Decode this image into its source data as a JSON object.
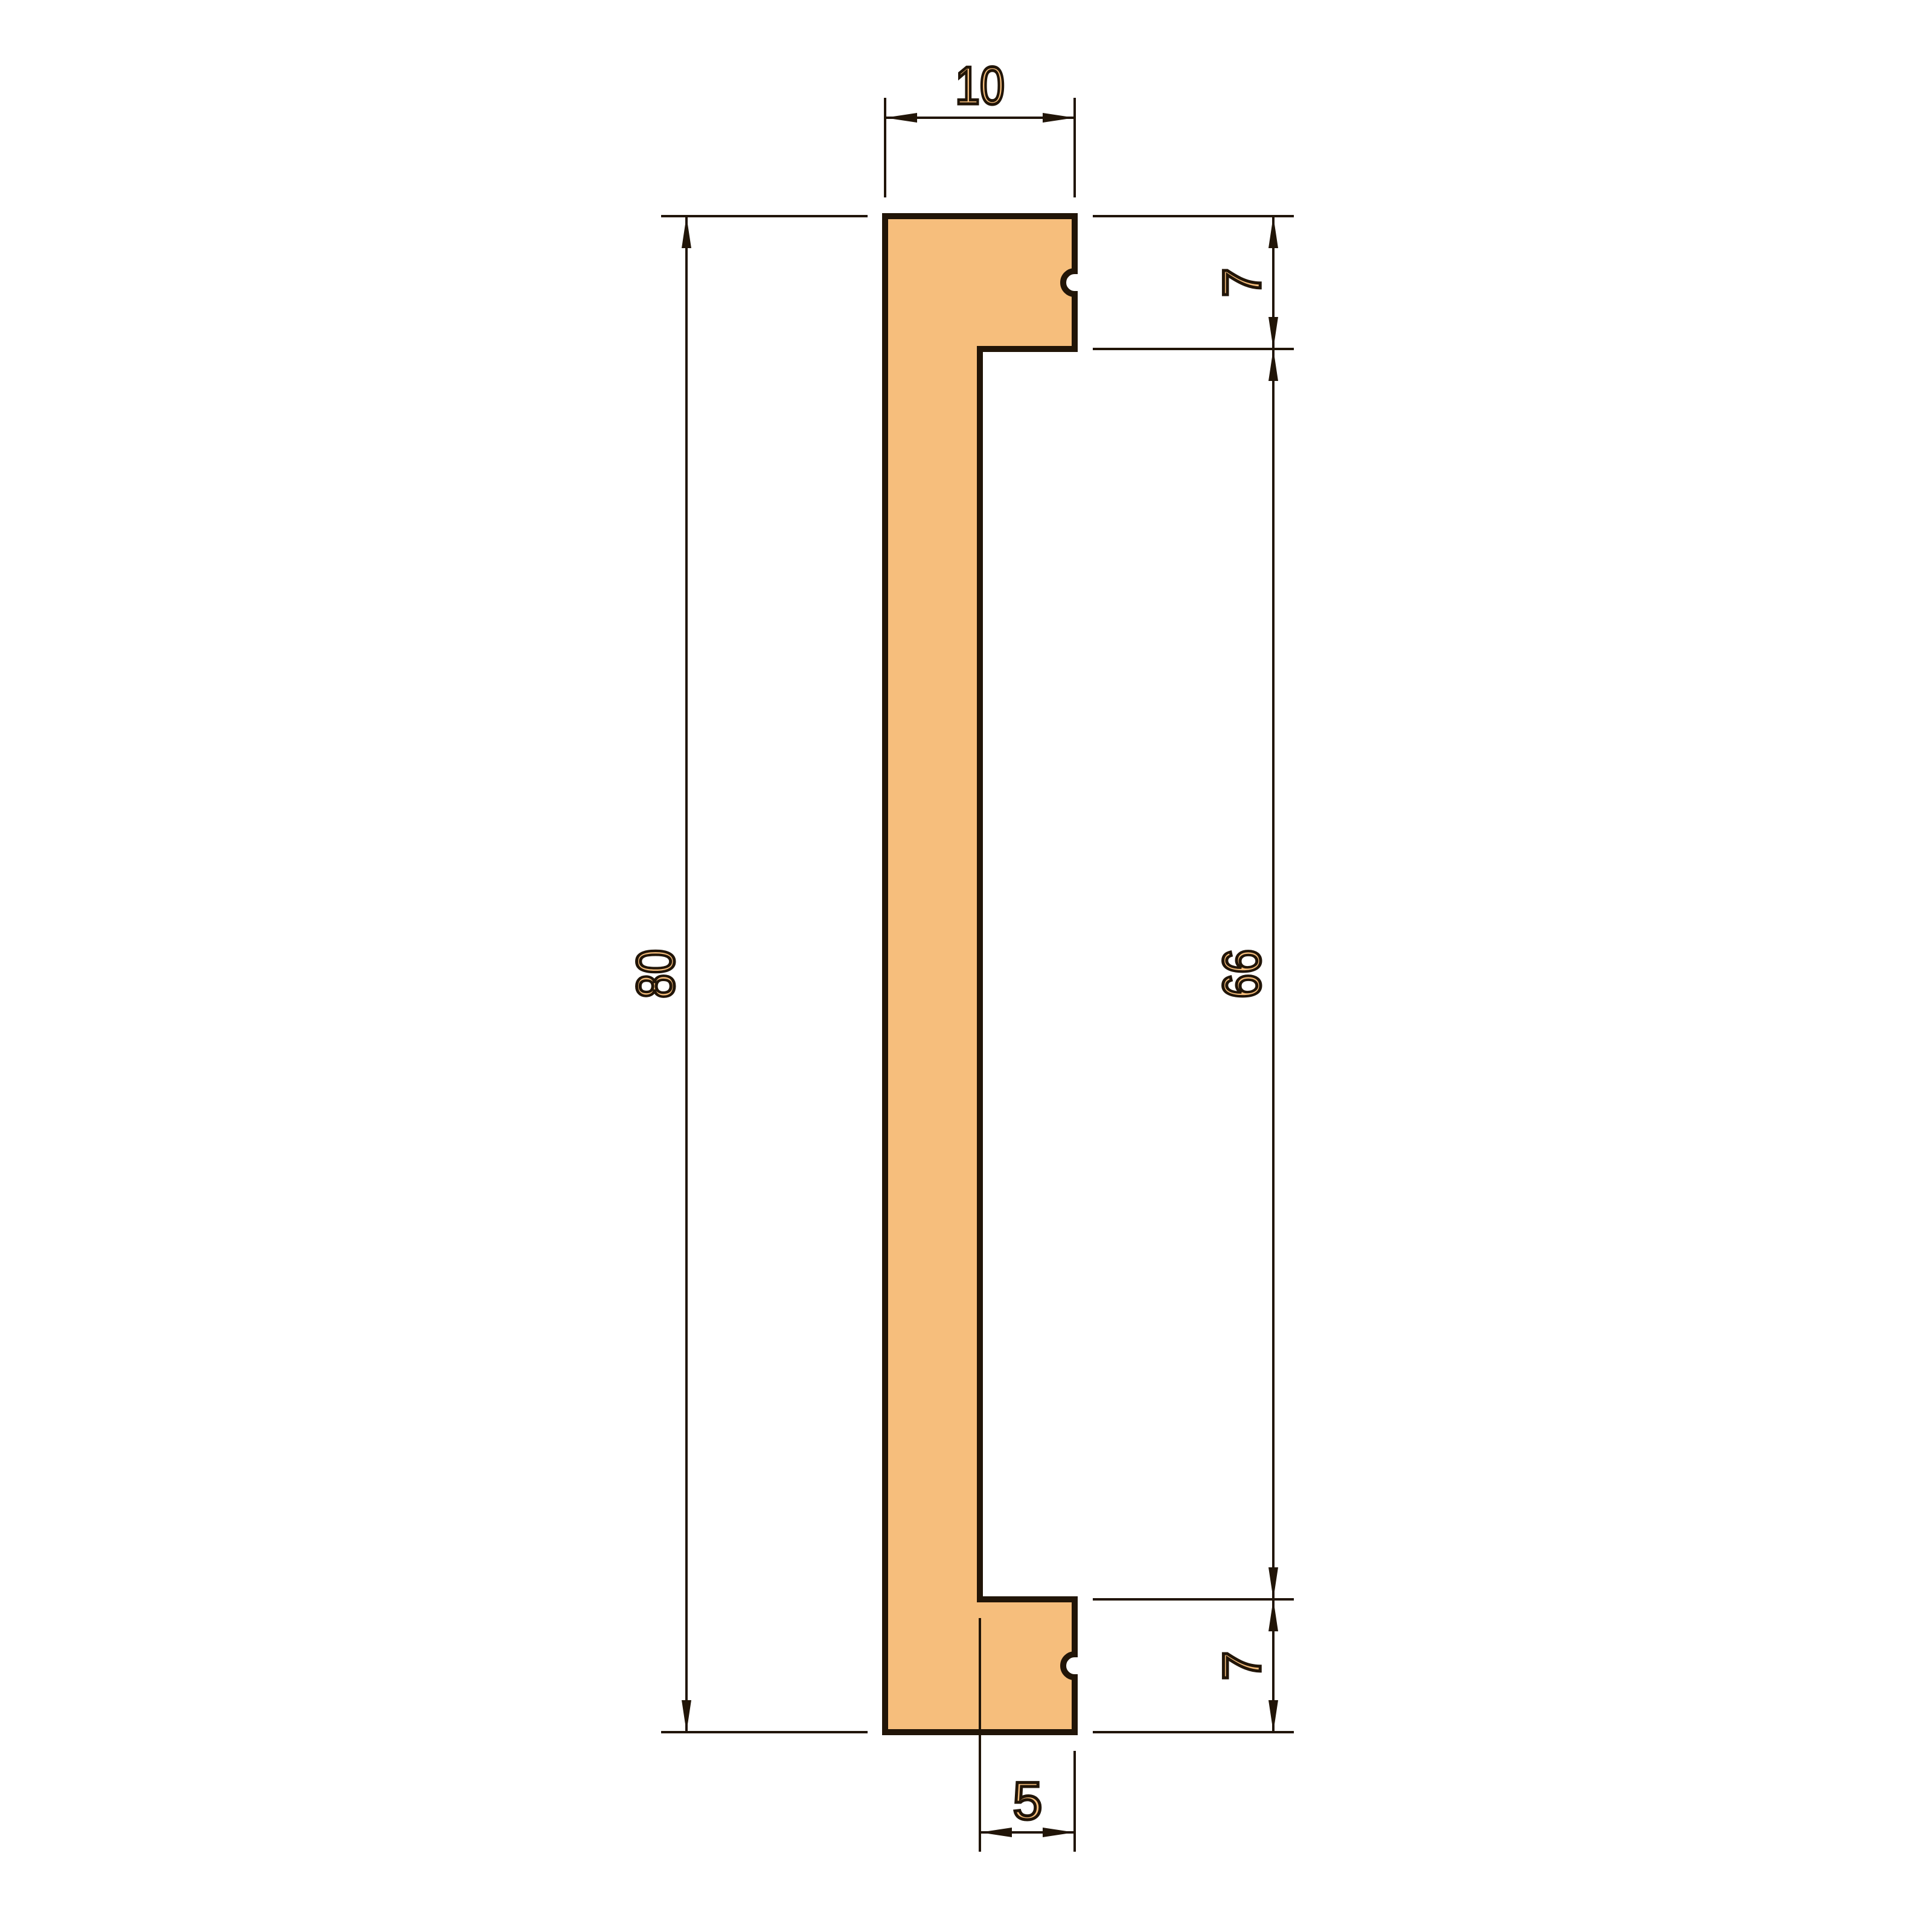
{
  "page": {
    "background_color": "#ffffff",
    "kind": "technical cross-section drawing"
  },
  "drawing": {
    "profile_fill_color": "#F6BE7C",
    "line_color": "#211508",
    "profile": {
      "overall_width": 10,
      "overall_height": 80,
      "top_flange_height": 7,
      "inner_height": 66,
      "bottom_flange_height": 7,
      "web_width": 5,
      "notch_count": 2
    },
    "dimensions": {
      "overall_width": "10",
      "overall_height": "80",
      "top_flange": "7",
      "inner_height": "66",
      "bottom_flange": "7",
      "bottom_web": "5"
    }
  }
}
